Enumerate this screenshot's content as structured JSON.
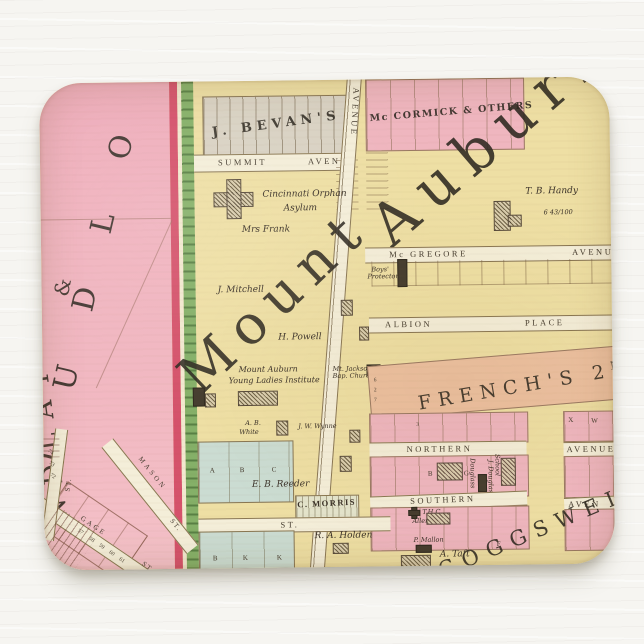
{
  "colors": {
    "background": "#f6f5f1",
    "pad_base_yellow": "#eedfa4",
    "pink_area": "#f1b5bf",
    "crimson_strip": "#d5526b",
    "green_strip": "#85b068",
    "grey_lots": "#d9d2c3",
    "mccormick_pink": "#efb6bf",
    "french_salmon": "#ecc0a0",
    "blue_block": "#cbdcd2",
    "street_cream": "#f4eed9",
    "line_brown": "#8a7752",
    "ink": "#3a3128"
  },
  "map": {
    "big_text": {
      "mount": "Mount",
      "auburn": "Auburn",
      "coggswell": "COGGSWELL",
      "frenchs": "FRENCH'S 2",
      "frenchs_sup": "ND",
      "mccormick": "Mc CORMICK & OTHERS",
      "bevans": "J. BEVAN'S",
      "ludlow": "LUDLO",
      "ampersand": "&",
      "findlay": "NDLAY"
    },
    "streets": {
      "summit": "SUMMIT",
      "summit_ave": "AVENUE",
      "avenue_vert": "AVENUE",
      "auburn_vert": "URN",
      "mcgregore": "Mc GREGORE",
      "mcgregore_ave": "AVENUE",
      "albion": "ALBION",
      "albion_place": "PLACE",
      "northern": "NORTHERN",
      "northern_ave": "AVENUE",
      "southern": "SOUTHERN",
      "southern_ave": "AVEN",
      "st_center": "ST.",
      "mason": "MASON",
      "mason_st": "ST.",
      "gage": "GAGE",
      "gage_st": "ST.",
      "left_st": "ST."
    },
    "owners": {
      "orphan1": "Cincinnati Orphan",
      "orphan2": "Asylum",
      "frank": "Mrs Frank",
      "mitchell": "J. Mitchell",
      "powell": "H. Powell",
      "inst1": "Mount Auburn",
      "inst2": "Young Ladies Institute",
      "church1": "Mt. Jackson",
      "church2": "Bap. Church",
      "handy": "T. B. Handy",
      "handy_acres": "6 43/100",
      "boys1": "Boys'",
      "boys2": "Protectory",
      "white1": "A. B.",
      "white2": "White",
      "wynne": "J. W. Wynne",
      "reeder": "E. B. Reeder",
      "morris": "C. MORRIS",
      "holden": "R. A. Holden",
      "thc": "T.H.C.",
      "allen": "Allen",
      "mallon": "P. Mallon",
      "taft": "A. Taft",
      "douglass": "Douglass",
      "jdouglass": "J. Douglass",
      "school": "School"
    },
    "letters": {
      "a": "A",
      "b": "B",
      "c": "C",
      "bb": "B",
      "k1": "K",
      "k2": "K",
      "x": "X",
      "w": "W",
      "blkB": "B",
      "blkG": "G",
      "f": "F"
    },
    "lots": {
      "n74": "74",
      "n73": "73",
      "n72": "72",
      "n57": "57",
      "n58": "58",
      "n59": "59",
      "n60": "60",
      "n61": "61",
      "f6": "6",
      "f2": "2",
      "f7": "7",
      "n3": "3"
    }
  }
}
